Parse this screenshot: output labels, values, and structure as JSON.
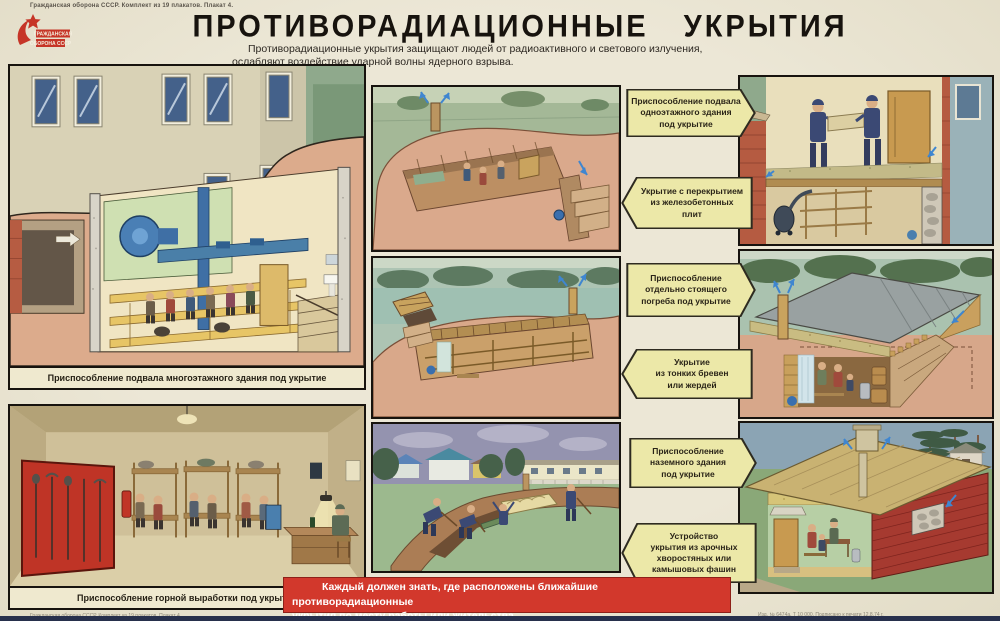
{
  "poster": {
    "top_note": "Гражданская оборона СССР. Комплект из 19 плакатов. Плакат 4.",
    "title": "ПРОТИВОРАДИАЦИОННЫЕ УКРЫТИЯ",
    "subtitle_line1": "Противорадиационные укрытия защищают людей от радиоактивного и светового излучения,",
    "subtitle_line2": "ослабляют воздействие ударной волны ядерного взрыва."
  },
  "emblem": {
    "line1": "ГРАЖДАНСКАЯ",
    "line2": "ОБОРОНА СССР"
  },
  "panels": {
    "basement_multistory": {
      "caption": "Приспособление подвала многоэтажного здания под укрытие"
    },
    "mine_gallery": {
      "caption": "Приспособление горной выработки под укрытие"
    }
  },
  "callouts": [
    {
      "text": "Приспособление подвала\nодноэтажного здания\nпод укрытие",
      "direction": "right"
    },
    {
      "text": "Укрытие с перекрытием\nиз железобетонных\nплит",
      "direction": "left"
    },
    {
      "text": "Приспособление\nотдельно стоящего\nпогреба под укрытие",
      "direction": "right"
    },
    {
      "text": "Укрытие\nиз тонких бревен\nили жердей",
      "direction": "left"
    },
    {
      "text": "Приспособление\nназемного здания\nпод укрытие",
      "direction": "right"
    },
    {
      "text": "Устройство\nукрытия из арочных\nхворостяных или\nкамышовых фашин",
      "direction": "left"
    }
  ],
  "banner": {
    "line1": "Каждый должен знать, где расположены ближайшие противорадиационные",
    "line2": "укрытия по месту работы или жительства."
  },
  "footer": {
    "left": "Гражданская оборона СССР. Комплект из 19 плакатов. Плакат 4.",
    "right": "Изд. № 6474а. Т 10 000. Подписано к печати 12.8.74 г."
  },
  "colors": {
    "poster_bg": "#e9e4d2",
    "banner_red": "#d2382c",
    "callout_yellow": "#ece8a8",
    "emblem_red": "#c63527"
  }
}
